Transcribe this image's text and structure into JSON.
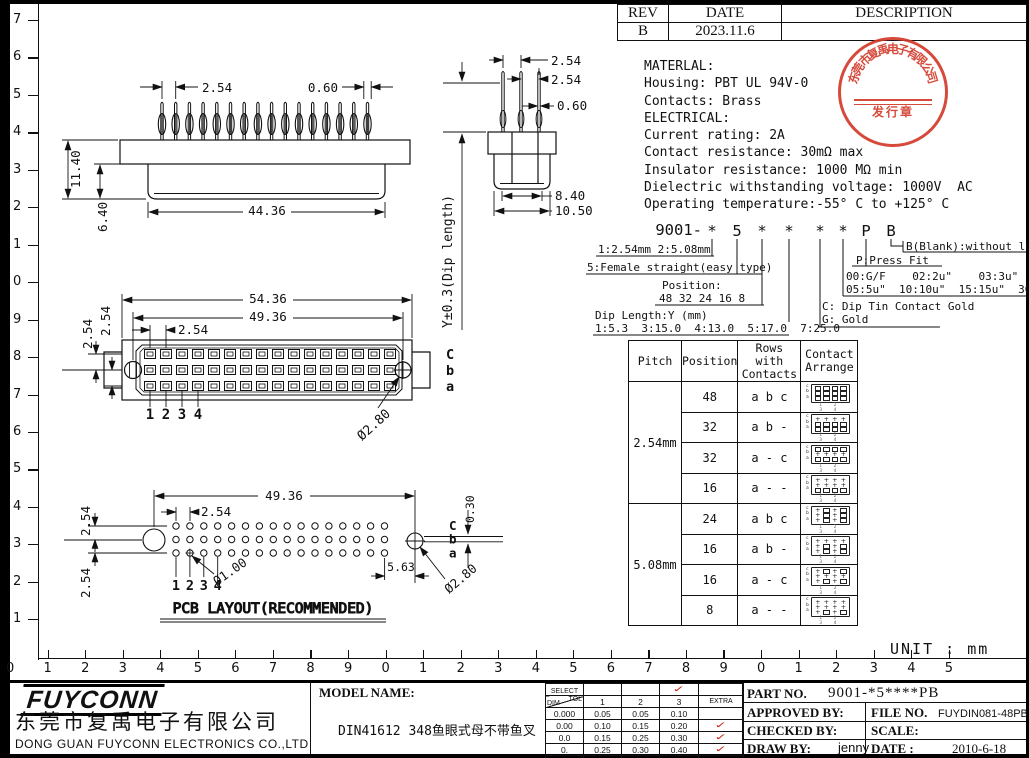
{
  "unit_label": "UNIT : mm",
  "colors": {
    "ink": "#111111",
    "stamp_red": "#d33b2b",
    "check_red": "#cc2418"
  },
  "rulers": {
    "left": [
      "7",
      "6",
      "5",
      "4",
      "3",
      "2",
      "1",
      "0",
      "9",
      "8",
      "7",
      "6",
      "5",
      "4",
      "3",
      "2",
      "1"
    ],
    "bottom": [
      "0",
      "1",
      "2",
      "3",
      "4",
      "5",
      "6",
      "7",
      "8",
      "9",
      "0",
      "1",
      "2",
      "3",
      "4",
      "5",
      "6",
      "7",
      "8",
      "9",
      "0",
      "1",
      "2",
      "3",
      "4",
      "5"
    ]
  },
  "rev_table": {
    "headers": [
      "REV",
      "DATE",
      "DESCRIPTION"
    ],
    "row": {
      "rev": "B",
      "date": "2023.11.6",
      "description": ""
    }
  },
  "specs": [
    "MATERLAL:",
    "Housing: PBT UL 94V-0",
    "Contacts: Brass",
    "ELECTRICAL:",
    "Current rating: 2A",
    "Contact resistance: 30mΩ max",
    "Insulator resistance: 1000 MΩ min",
    "Dielectric withstanding voltage: 1000V  AC",
    "Operating temperature:-55° C to +125° C"
  ],
  "stamp": {
    "company": "东莞市复禹电子有限公司",
    "label": "发行章"
  },
  "scheme": {
    "prefix": "9001-",
    "chars": [
      "*",
      "5",
      "*",
      "*",
      "*",
      "*",
      "P",
      "B"
    ],
    "l1": "1:2.54mm 2:5.08mm",
    "l2": "5:Female straight(easy type)",
    "l3a": "Position:",
    "l3b": "48 32 24 16 8",
    "l4a": "Dip Length:Y (mm)",
    "l4b": "1:5.3  3:15.0  4:13.0  5:17.0  7:25.0",
    "l5a": "C: Dip Tin Contact Gold",
    "l5b": "G: Gold",
    "l6a": "00:G/F    02:2u\"    03:3u\"",
    "l6b": "05:5u\"  10:10u\"  15:15u\"  30:30u\"",
    "l7": "P:Press Fit",
    "l8": "B(Blank):without lock"
  },
  "contact_table": {
    "headers": [
      "Pitch",
      "Position",
      "Rows with Contacts",
      "Contact Arrange"
    ],
    "icon_rows": [
      "c",
      "b",
      "a"
    ],
    "icon_cols": "1 2 3 4",
    "groups": [
      {
        "pitch": "2.54mm",
        "rows": [
          {
            "position": "48",
            "rows_with": "a b c",
            "pattern": [
              "1111",
              "1111",
              "1111"
            ]
          },
          {
            "position": "32",
            "rows_with": "a b -",
            "pattern": [
              "0000",
              "1111",
              "1111"
            ]
          },
          {
            "position": "32",
            "rows_with": "a - c",
            "pattern": [
              "1111",
              "0000",
              "1111"
            ]
          },
          {
            "position": "16",
            "rows_with": "a - -",
            "pattern": [
              "0000",
              "0000",
              "1111"
            ]
          }
        ]
      },
      {
        "pitch": "5.08mm",
        "rows": [
          {
            "position": "24",
            "rows_with": "a b c",
            "pattern": [
              "0101",
              "0101",
              "0101"
            ]
          },
          {
            "position": "16",
            "rows_with": "a b -",
            "pattern": [
              "0000",
              "0101",
              "0101"
            ]
          },
          {
            "position": "16",
            "rows_with": "a - c",
            "pattern": [
              "0101",
              "0000",
              "0101"
            ]
          },
          {
            "position": "8",
            "rows_with": "a - -",
            "pattern": [
              "0000",
              "0000",
              "0101"
            ]
          }
        ]
      }
    ]
  },
  "views": {
    "side": {
      "pins": 16,
      "dim_pitch": "2.54",
      "dim_pin": "0.60",
      "dim_h": "11.40",
      "dim_h2": "6.40",
      "dim_w": "44.36"
    },
    "end": {
      "pins": 3,
      "dim_p1": "2.54",
      "dim_p2": "2.54",
      "dim_pin": "0.60",
      "dim_w1": "8.40",
      "dim_w2": "10.50",
      "dip_label": "Y±0.3(Dip length)"
    },
    "front": {
      "ncols": 16,
      "dim_w1": "54.36",
      "dim_w2": "49.36",
      "dim_pitch": "2.54",
      "dim_r1": "2.54",
      "dim_r2": "2.54",
      "hole": "Ø2.80",
      "rows": [
        "C",
        "b",
        "a"
      ],
      "cols": [
        "1",
        "2",
        "3",
        "4"
      ]
    },
    "pcb": {
      "ncols": 16,
      "title": "PCB LAYOUT(RECOMMENDED)",
      "dim_w": "49.36",
      "dim_pitch": "2.54",
      "dim_r1": "2.54",
      "dim_r2": "2.54",
      "dim_off": "0.30",
      "dim_edge": "5.63",
      "hole_small": "Ø1.00",
      "hole_big": "Ø2.80",
      "rows": [
        "C",
        "b",
        "a"
      ],
      "cols": [
        "1",
        "2",
        "3",
        "4"
      ]
    }
  },
  "tolerance_table": {
    "select_label": "SELECT",
    "dim_label": "DIM",
    "tol_label": "TOL",
    "cols": [
      "1",
      "2",
      "3",
      "EXTRA"
    ],
    "selected_col_index": 2,
    "rows": [
      {
        "dim": "0.000",
        "v": [
          "0.05",
          "0.05",
          "0.10"
        ],
        "extra": false
      },
      {
        "dim": "0.00",
        "v": [
          "0.10",
          "0.15",
          "0.20"
        ],
        "extra": true
      },
      {
        "dim": "0.0",
        "v": [
          "0.15",
          "0.25",
          "0.30"
        ],
        "extra": true
      },
      {
        "dim": "0.",
        "v": [
          "0.25",
          "0.30",
          "0.40"
        ],
        "extra": true
      },
      {
        "dim": "ANGLE",
        "v": [
          "1.0°",
          "3.0°",
          "5.0°"
        ],
        "extra": true
      }
    ]
  },
  "title_block": {
    "logo": "FUYCONN",
    "company_cn": "东莞市复禹电子有限公司",
    "company_en": "DONG GUAN FUYCONN ELECTRONICS CO.,LTD",
    "model_label": "MODEL NAME:",
    "model_name": "DIN41612  348鱼眼式母不带鱼叉",
    "part_label": "PART NO.",
    "part_no": "9001-*5****PB",
    "approved_label": "APPROVED BY:",
    "checked_label": "CHECKED BY:",
    "draw_label": "DRAW BY:",
    "draw_by": "jenny",
    "file_label": "FILE NO.",
    "file_no": "FUYDIN081-48PB",
    "scale_label": "SCALE:",
    "date_label": "DATE :",
    "date": "2010-6-18"
  }
}
